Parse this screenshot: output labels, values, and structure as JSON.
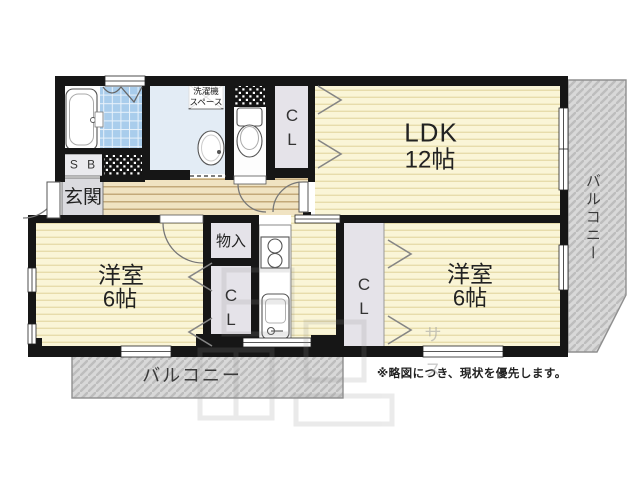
{
  "rooms": {
    "ldk": {
      "name": "LDK",
      "size": "12帖"
    },
    "western_left": {
      "name": "洋室",
      "size": "6帖"
    },
    "western_right": {
      "name": "洋室",
      "size": "6帖"
    }
  },
  "labels": {
    "entrance": "玄関",
    "shoe_box": "S B",
    "storage": "物入",
    "closet_line1": "C",
    "closet_line2": "L",
    "washer_line1": "洗濯機",
    "washer_line2": "スペース",
    "balcony": "バルコニー"
  },
  "note": "※略図につき、現状を優先します。",
  "watermark": {
    "char1": "サ",
    "char2": "ス"
  },
  "colors": {
    "wall": "#161616",
    "room_fill": "#faf5d7",
    "room_stripe": "#e7dcab",
    "wood_fill": "#f0e3c2",
    "wood_stripe": "#c3a97a",
    "tile_blue": "#a9cdec",
    "washroom_blue": "#e3ecf5",
    "closet_gray": "#e5e3e9",
    "entrance_gray": "#dbdbdf",
    "balcony_gray": "#d8d8d8",
    "balcony_stripe": "#bdbdbd"
  }
}
